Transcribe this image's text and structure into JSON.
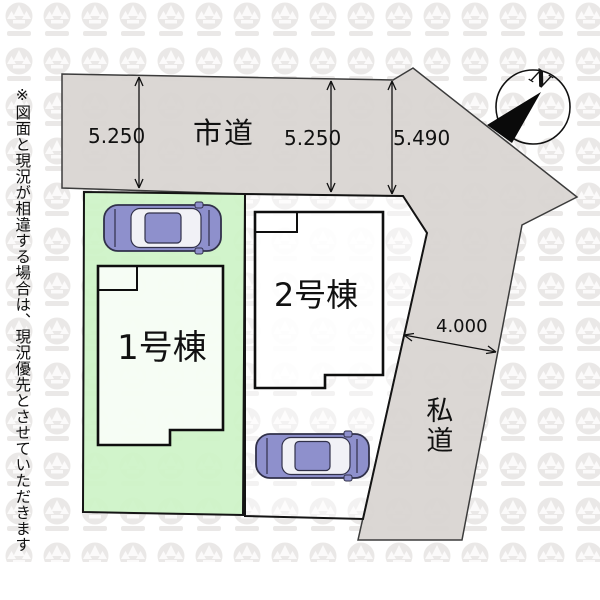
{
  "disclaimer": "※図面と現況が相違する場合は、現況優先とさせていただきます",
  "city_road": {
    "label": "市道",
    "dim_left": "5.250",
    "dim_middle": "5.250",
    "dim_right": "5.490"
  },
  "private_road": {
    "label": "私道",
    "width_dim": "4.000"
  },
  "buildings": [
    {
      "label": "1号棟"
    },
    {
      "label": "2号棟"
    }
  ],
  "compass": {
    "north": "N"
  },
  "colors": {
    "road_fill": "#d9d5d2",
    "plot1_fill": "#cdf3c7",
    "plot2_fill": "#ffffff",
    "building_fill": "#ffffff",
    "outline": "#1a1a1a",
    "car_body": "#8e90cc",
    "car_glass": "#f1f1f6",
    "car_outline": "#31314a",
    "watermark": "#e7e5e3",
    "watermark_inner": "#fbfafa"
  }
}
